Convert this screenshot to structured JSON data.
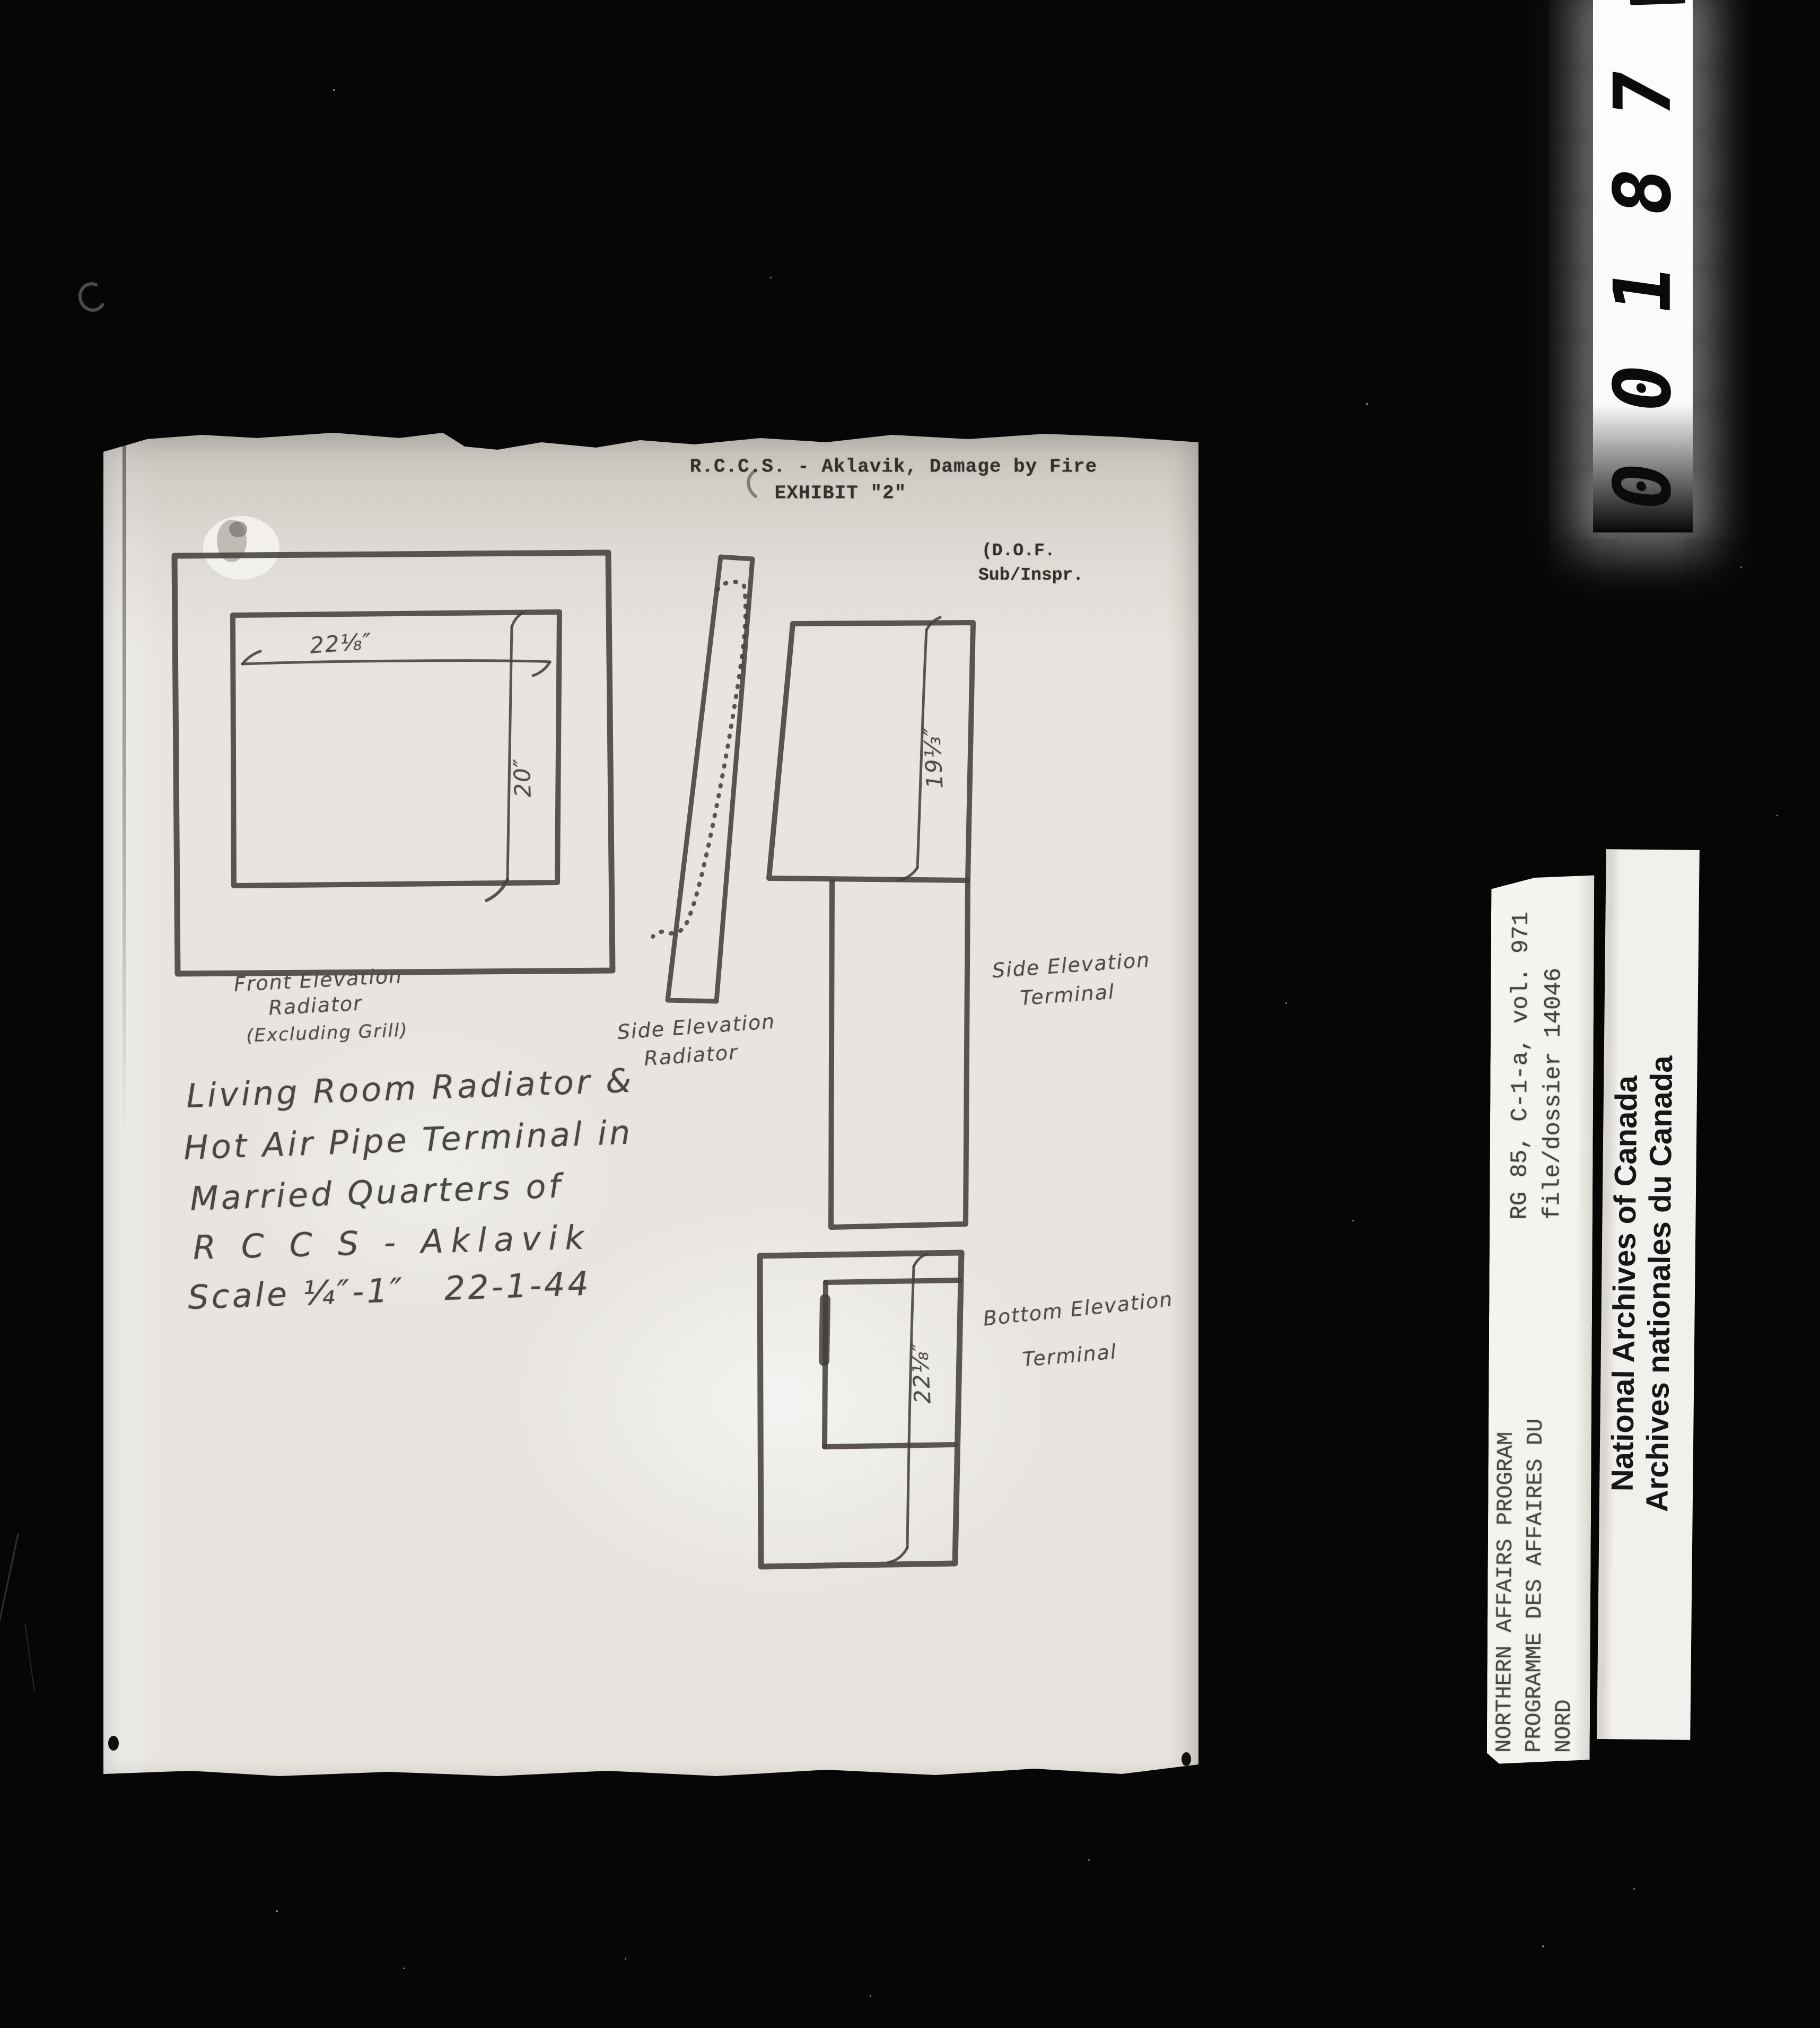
{
  "page_header": {
    "title": "R.C.C.S. - Aklavik, Damage by Fire",
    "exhibit": "EXHIBIT \"2\"",
    "initials": "(D.O.F.",
    "rank": "Sub/Inspr."
  },
  "sketch": {
    "front_elevation": {
      "label1": "Front Elevation",
      "label2": "Radiator",
      "label3": "(Excluding Grill)",
      "width_dim": "22⅛″",
      "height_dim": "20″"
    },
    "side_radiator": {
      "label1": "Side Elevation",
      "label2": "Radiator"
    },
    "side_terminal": {
      "label1": "Side Elevation",
      "label2": "Terminal",
      "depth_dim": "19⅓″"
    },
    "bottom_terminal": {
      "label1": "Bottom Elevation",
      "label2": "Terminal",
      "length_dim": "22⅛″"
    }
  },
  "caption": {
    "line1": "Living Room Radiator &",
    "line2": "Hot Air Pipe Terminal in",
    "line3": "Married Quarters of",
    "line4": "R C C S - Aklavik",
    "line5": "Scale ¼″-1″   22-1-44"
  },
  "archive_labels": {
    "reference_line1": "RG 85, C-1-a, vol. 971",
    "reference_line2": "file/dossier 14046",
    "program_line1": "NORTHERN AFFAIRS PROGRAM",
    "program_line2": "PROGRAMME DES AFFAIRES DU",
    "program_line3": "NORD",
    "institution_line1": "National Archives of Canada",
    "institution_line2": "Archives nationales du Canada"
  },
  "film": {
    "frame_counter": "00187"
  },
  "colors": {
    "background": "#060606",
    "paper": "#e8e5e0",
    "pencil": "#44403b",
    "ink": "#34312d",
    "label_paper": "#f3f1ed"
  }
}
